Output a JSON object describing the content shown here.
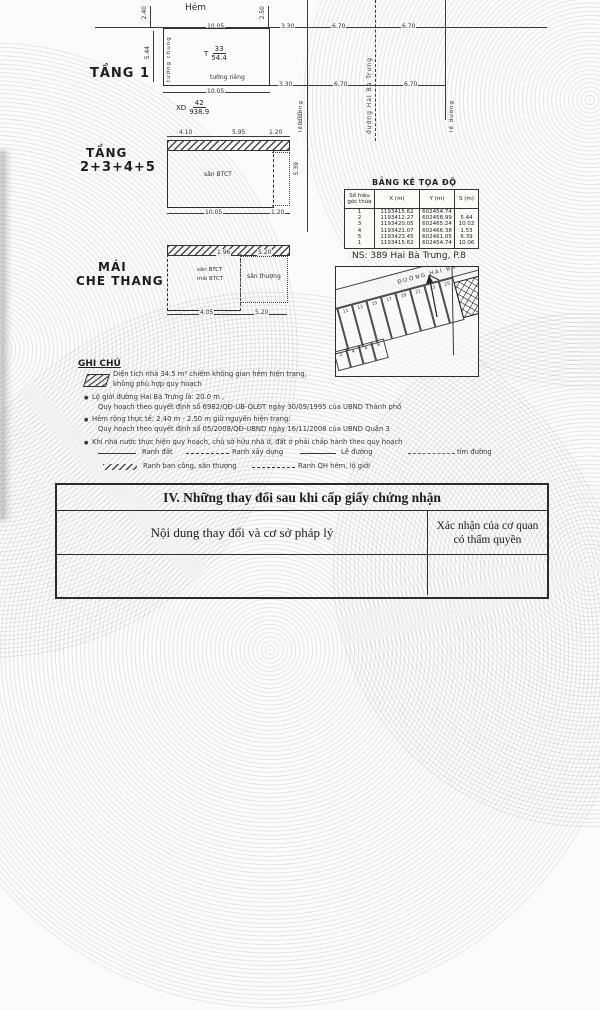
{
  "labels": {
    "hem": "Hẻm",
    "tang1": "TẦNG 1",
    "tang2_l1": "TẦNG",
    "tang2_l2": "2+3+4+5",
    "mai_l1": "MÁI",
    "mai_l2": "CHE THANG"
  },
  "plans": {
    "tang1": {
      "lot_prefix": "T",
      "lot_num": "33",
      "lot_area": "54.4",
      "xd_prefix": "XD",
      "xd_num": "42",
      "xd_area": "938.9",
      "wall_left": "tường chung",
      "wall_bottom": "tường riêng"
    },
    "tang2345": {
      "inside": "sân BTCT"
    },
    "mai": {
      "left1": "sân BTCT",
      "left2": "mái BTCT",
      "right": "sân thượng"
    }
  },
  "dims": {
    "hem_left": "2.40",
    "hem_right": "2.50",
    "t1_top": "10.05",
    "t1_bottom": "10.05",
    "t1_left": "5.44",
    "chain1": [
      "3.30",
      "6.70",
      "6.70"
    ],
    "chain2": [
      "3.30",
      "6.70",
      "6.70"
    ],
    "t2_top": [
      "4.10",
      "5.95",
      "1.20"
    ],
    "t2_right": "5.39",
    "t2_bottom": "10.05",
    "t2_bottom_right": "1.20",
    "t2_small": "0.70",
    "mai_top": [
      "1.96",
      "5.20"
    ],
    "mai_bottom": [
      "4.05",
      "5.20"
    ]
  },
  "road": {
    "curb_near": "lề đường",
    "curb_far": "lề đường",
    "street_axis": "đường Hai Bà Trưng"
  },
  "toado": {
    "title": "BẢNG KÊ TỌA ĐỘ",
    "headers": [
      "Số hiệu góc thửa",
      "X (m)",
      "Y (m)",
      "S (m)"
    ],
    "rows": [
      [
        "1",
        "1193415.62",
        "602454.74",
        ""
      ],
      [
        "2",
        "1193412.27",
        "602458.99",
        "5.44"
      ],
      [
        "3",
        "1193420.05",
        "602465.24",
        "10.02"
      ],
      [
        "4",
        "1193421.07",
        "602466.38",
        "1.53"
      ],
      [
        "5",
        "1193423.45",
        "602461.05",
        "6.39"
      ],
      [
        "1",
        "1193415.62",
        "602454.74",
        "10.06"
      ]
    ]
  },
  "address": "NS: 389 Hai Bà Trưng, P.8",
  "map": {
    "street": "ĐƯỜNG HAI BÀ TRƯNG",
    "parcels": [
      "9",
      "11",
      "13",
      "15",
      "17",
      "19",
      "21",
      "23",
      "25"
    ],
    "parcels2": [
      "2",
      "4",
      "6",
      "8"
    ],
    "blocks": [
      "7",
      "5"
    ]
  },
  "notes": {
    "title": "GHI CHÚ",
    "hatch_note1": "Diện tích nhà 34.5 m² chiếm không gian hẻm hiện trạng,",
    "hatch_note2": "không phù hợp quy hoạch",
    "b1": "Lộ giới đường Hai Bà Trưng là: 20.0 m ,",
    "b1b": "Quy hoạch theo quyết định số 6982/QĐ-UB-QLĐT ngày 30/09/1995 của UBND Thành phố",
    "b2": "Hẻm rộng thực tế: 2.40 m - 2.50 m giữ nguyên hiện trạng:",
    "b2b": "Quy hoạch theo quyết định số 05/2008/QĐ-UBND ngày 16/11/2008 của UBND Quận 3",
    "b3": "Khi nhà nước thực hiện quy hoạch, chủ sở hữu nhà ở, đất ở phải chấp hành theo quy hoạch",
    "legend": [
      {
        "label": "Ranh đất"
      },
      {
        "label": "Ranh xây dựng"
      },
      {
        "label": "Lề đường"
      },
      {
        "label": "tim đường"
      },
      {
        "label": "Ranh ban công, sân thượng"
      },
      {
        "label": "Ranh QH hẻm, lộ giới"
      }
    ]
  },
  "section4": {
    "title": "IV. Những thay đổi sau khi cấp giấy chứng nhận",
    "col_left": "Nội dung thay đổi và cơ sở pháp lý",
    "col_right1": "Xác nhận của cơ quan",
    "col_right2": "có thẩm quyền"
  }
}
